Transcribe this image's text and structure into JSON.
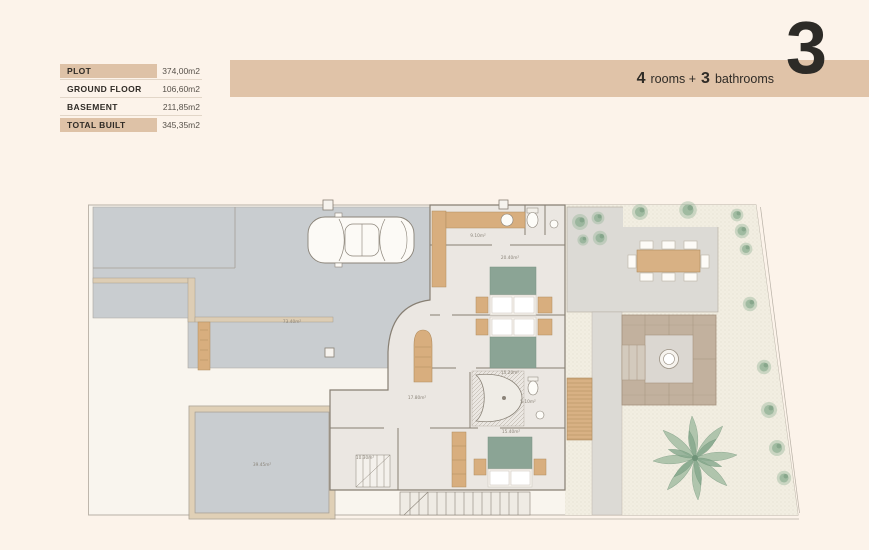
{
  "header": {
    "spec_table": {
      "rows": [
        {
          "label": "PLOT",
          "value": "374,00m2",
          "highlight": true
        },
        {
          "label": "GROUND FLOOR",
          "value": "106,60m2",
          "highlight": false
        },
        {
          "label": "BASEMENT",
          "value": "211,85m2",
          "highlight": false
        },
        {
          "label": "TOTAL BUILT",
          "value": "345,35m2",
          "highlight": true
        }
      ]
    },
    "banner": {
      "rooms_count": "4",
      "rooms_label": "rooms +",
      "bath_count": "3",
      "bath_label": "bathrooms",
      "big_number": "3",
      "color": "#e0c3a8"
    }
  },
  "floor_plan": {
    "colors": {
      "page_background": "#fcf3ea",
      "plot_fill": "#f9f5ee",
      "paving_gray": "#c9cdd0",
      "patio_gray": "#dcdad5",
      "gravel": "#f2eee2",
      "house_floor": "#ebe7e2",
      "wall_line": "#877f73",
      "wood": "#d8ae7e",
      "bed_green": "#8ba495",
      "plant_green": "#83a98a",
      "lounge_taupe": "#c2b19e"
    },
    "area_labels": [
      {
        "id": "driveway",
        "text": "73.40m²",
        "x": 204,
        "y": 126
      },
      {
        "id": "storage",
        "text": "39.45m²",
        "x": 174,
        "y": 269
      },
      {
        "id": "laundry",
        "text": "9.10m²",
        "x": 390,
        "y": 40
      },
      {
        "id": "bedroom-1",
        "text": "20.40m²",
        "x": 422,
        "y": 62
      },
      {
        "id": "corridor",
        "text": "15.20m²",
        "x": 422,
        "y": 177
      },
      {
        "id": "bathroom",
        "text": "5.10m²",
        "x": 440,
        "y": 206
      },
      {
        "id": "bedroom-3",
        "text": "15.40m²",
        "x": 423,
        "y": 236
      },
      {
        "id": "hall",
        "text": "17.80m²",
        "x": 329,
        "y": 202
      },
      {
        "id": "west-room",
        "text": "10.30m²",
        "x": 277,
        "y": 262
      }
    ]
  }
}
